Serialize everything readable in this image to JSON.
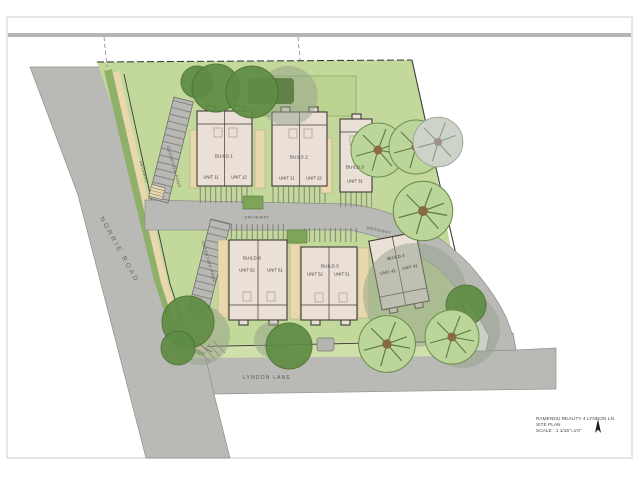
{
  "drawing": {
    "roads": {
      "norrie": "NORRIE ROAD",
      "lyndon": "LYNDON LANE",
      "driveway_upper": "DRIVEWAY",
      "driveway_lower": "DRIVEWAY",
      "pathway": "PATHWAY"
    },
    "features": {
      "detention_upper": "DETENTION POND",
      "detention_lower": "DETENTION POND"
    },
    "buildings": [
      {
        "name": "BUILD.1",
        "units": [
          "UNIT 11",
          "UNIT 12"
        ]
      },
      {
        "name": "BUILD.2",
        "units": [
          "UNIT 21",
          "UNIT 22"
        ]
      },
      {
        "name": "BUILD.3",
        "units": [
          "UNIT 31"
        ]
      },
      {
        "name": "BUILD.4",
        "units": [
          "UNIT 42",
          "UNIT 41"
        ]
      },
      {
        "name": "BUILD.5",
        "units": [
          "UNIT 52",
          "UNIT 51"
        ]
      },
      {
        "name": "BUILD.6",
        "units": [
          "UNIT 62",
          "UNIT 61"
        ]
      }
    ],
    "title_block": {
      "project": "RAMENDU REALITY 4 LYNDON LN",
      "sheet": "SITE PLAN",
      "scale": "SCALE : 1 1/16\"=1'0\""
    },
    "colors": {
      "road": "#b9b9b6",
      "lawn": "#c3d89b",
      "lawn_light": "#cfe0ab",
      "verge": "#8fb069",
      "path_tan": "#e9d8ae",
      "building": "#eae0d8",
      "building_line": "#3f3a36",
      "tree_dark": "#5f8c44",
      "tree_light": "#bcd59a",
      "shadow": "#96a28b",
      "boundary": "#3c3c38",
      "band": "#b5b5b3"
    }
  }
}
